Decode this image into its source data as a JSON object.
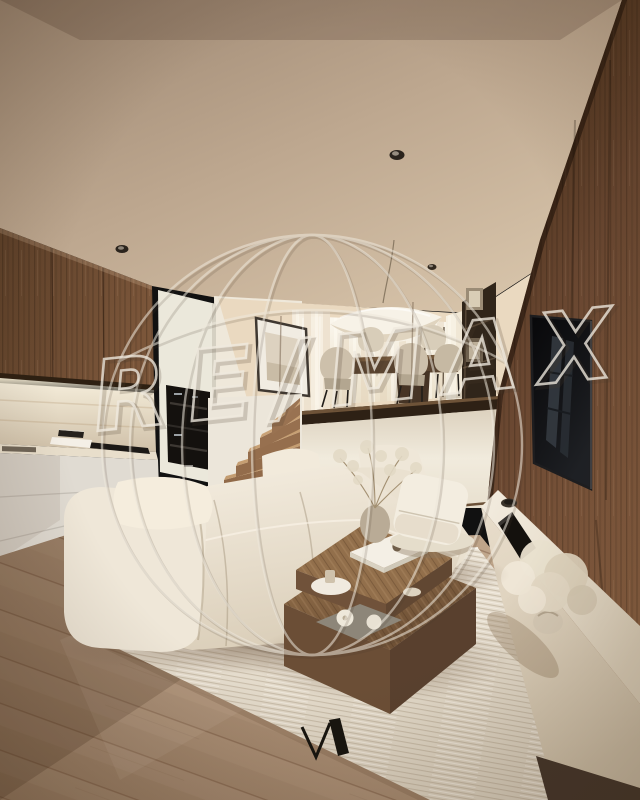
{
  "watermark": {
    "text": "RE/MAX",
    "shape": "hot-air-balloon-outline",
    "stroke_light": "#eee8dc",
    "stroke_dark": "#4a3b2c"
  },
  "branding": {
    "bottom_logo_glyph": "VA-monogram",
    "color": "#18150f"
  },
  "palette": {
    "ceiling": "#c2ac94",
    "wood_accent_wall": "#6a4830",
    "kitchen_upper_cabinets": "#6e4c34",
    "backsplash": "#e8dcc5",
    "lower_cabinets": "#e1dcd3",
    "oven": "#14110e",
    "mezzanine_wall": "#ecdcc4",
    "window_light": "#faf6ec",
    "pendant_lamp": "#f6f1e6",
    "dining_chair": "#cdc1ab",
    "dining_table": "#5b4531",
    "stairs_wood": "#96704e",
    "tv_screen": "#0c0c0e",
    "console": "#ece4d6",
    "sofa": "#ece4d4",
    "coffee_table": "#7e5e40",
    "rug": "#e8e1d2",
    "floor": "#ab8f77"
  }
}
